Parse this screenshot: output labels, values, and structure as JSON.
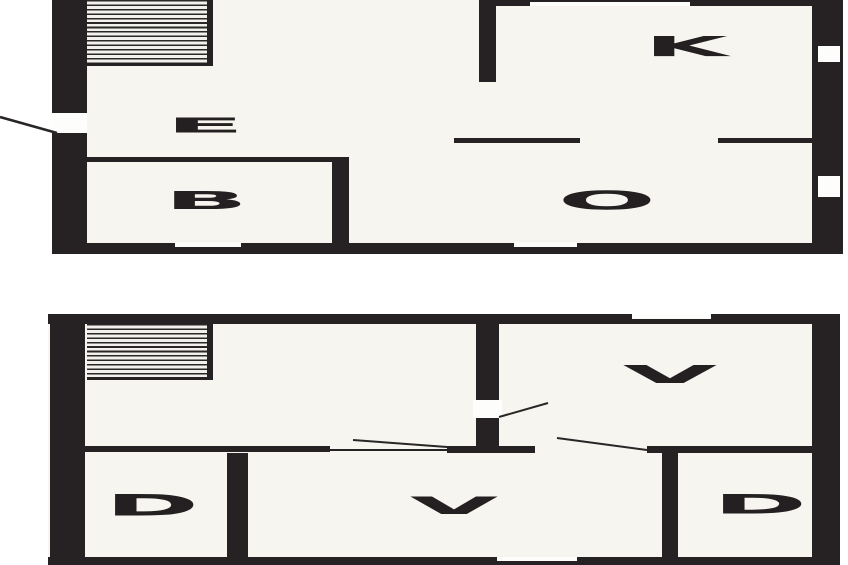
{
  "colors": {
    "ink": "#262122",
    "room_fill": "#f6f5f0",
    "background": "#ffffff"
  },
  "floors": [
    {
      "name": "upper-floor-plan",
      "rooms": [
        {
          "label": "E"
        },
        {
          "label": "B"
        },
        {
          "label": "K"
        },
        {
          "label": "O"
        }
      ]
    },
    {
      "name": "lower-floor-plan",
      "rooms": [
        {
          "label": "V"
        },
        {
          "label": "V"
        },
        {
          "label": "D"
        },
        {
          "label": "D"
        }
      ]
    }
  ]
}
